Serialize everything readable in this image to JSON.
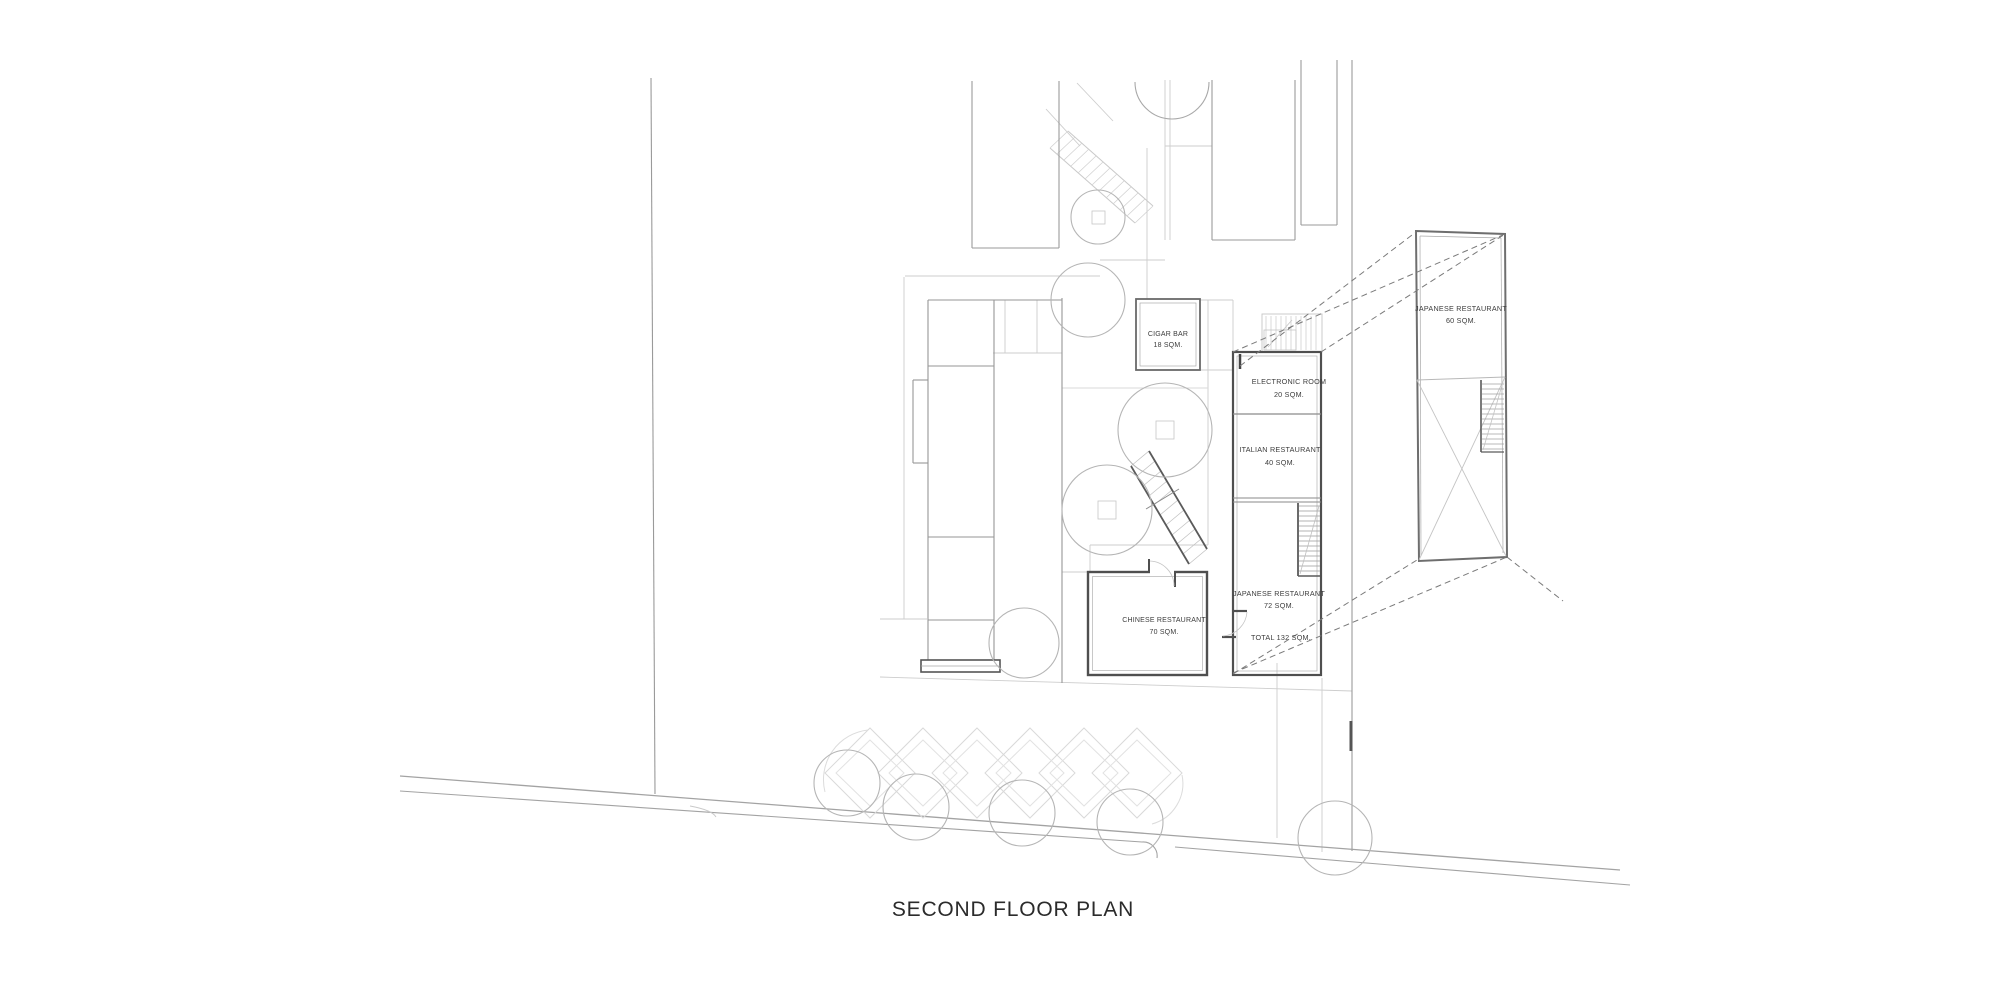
{
  "drawing": {
    "title": "SECOND FLOOR PLAN",
    "rooms": {
      "cigar_bar": {
        "name": "CIGAR BAR",
        "area": "18 SQM."
      },
      "electronic_room": {
        "name": "ELECTRONIC ROOM",
        "area": "20 SQM."
      },
      "italian": {
        "name": "ITALIAN RESTAURANT",
        "area": "40 SQM."
      },
      "japanese_72": {
        "name": "JAPANESE RESTAURANT",
        "area": "72 SQM."
      },
      "chinese": {
        "name": "CHINESE RESTAURANT",
        "area": "70 SQM."
      },
      "japanese_60": {
        "name": "JAPANESE RESTAURANT",
        "area": "60 SQM."
      }
    },
    "annotations": {
      "total": "TOTAL 132 SQM."
    },
    "colors": {
      "wall_dark": "#4f4f4f",
      "line_medium": "#9a9a9a",
      "line_light": "#cdcdcd",
      "tree": "#b5b5b5",
      "text": "#3c3c3c"
    }
  }
}
